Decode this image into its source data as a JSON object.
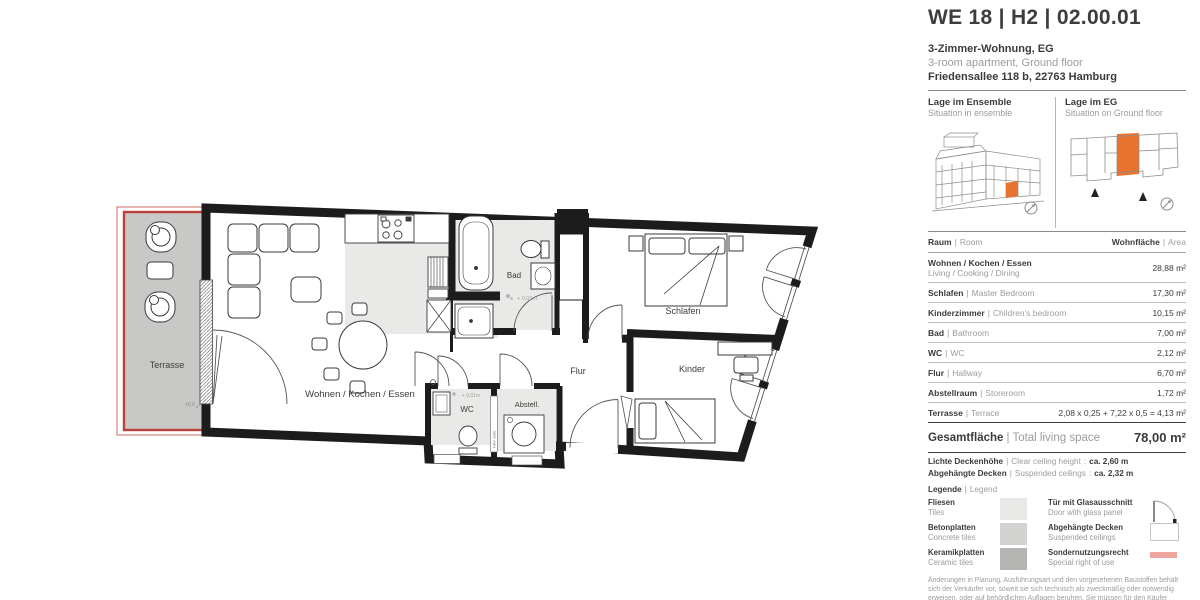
{
  "ui": {
    "sep": "|",
    "colon": ":"
  },
  "header": {
    "title": "WE 18 | H2 | 02.00.01",
    "subtitle_de": "3-Zimmer-Wohnung, EG",
    "subtitle_en": "3-room apartment, Ground floor",
    "address": "Friedensallee 118 b, 22763 Hamburg"
  },
  "location": {
    "ensemble_title": "Lage im Ensemble",
    "ensemble_sub": "Situation in ensemble",
    "floor_title": "Lage im EG",
    "floor_sub": "Situation on Ground floor"
  },
  "table": {
    "header_room_de": "Raum",
    "header_room_en": "Room",
    "header_area_de": "Wohnfläche",
    "header_area_en": "Area",
    "rows": [
      {
        "de": "Wohnen / Kochen / Essen",
        "en": "Living / Cooking / Dining",
        "area": "28,88 m²"
      },
      {
        "de": "Schlafen",
        "en": "Master Bedroom",
        "area": "17,30 m²"
      },
      {
        "de": "Kinderzimmer",
        "en": "Children's bedroom",
        "area": "10,15 m²"
      },
      {
        "de": "Bad",
        "en": "Bathroom",
        "area": "7,00 m²"
      },
      {
        "de": "WC",
        "en": "WC",
        "area": "2,12 m²"
      },
      {
        "de": "Flur",
        "en": "Hallway",
        "area": "6,70 m²"
      },
      {
        "de": "Abstellraum",
        "en": "Storeroom",
        "area": "1,72 m²"
      },
      {
        "de": "Terrasse",
        "en": "Terrace",
        "area": "2,08 x 0,25 + 7,22 x 0,5 = 4,13 m²"
      }
    ],
    "total_de": "Gesamtfläche",
    "total_en": "Total living space",
    "total_area": "78,00 m²"
  },
  "ceiling": {
    "clear_de": "Lichte Deckenhöhe",
    "clear_en": "Clear ceiling height",
    "clear_value": "ca. 2,60 m",
    "susp_de": "Abgehängte Decken",
    "susp_en": "Suspended ceilings",
    "susp_value": "ca. 2,32 m"
  },
  "legend": {
    "title_de": "Legende",
    "title_en": "Legend",
    "items": [
      {
        "de": "Fliesen",
        "en": "Tiles"
      },
      {
        "de": "Betonplatten",
        "en": "Concrete tiles"
      },
      {
        "de": "Keramikplatten",
        "en": "Ceramic tiles"
      },
      {
        "de": "Tür mit Glasausschnitt",
        "en": "Door with glass panel"
      },
      {
        "de": "Abgehängte Decken",
        "en": "Suspended ceilings"
      },
      {
        "de": "Sondernutzungsrecht",
        "en": "Special right of use"
      }
    ]
  },
  "disclaimer": "Änderungen in Planung, Ausführungsart und den vorgesehenen Baustoffen behält sich der Verkäufer vor, soweit sie sich technisch als zweckmäßig oder notwendig erweisen, oder auf behördlichen Auflagen beruhen. Sie müssen für den Käufer zumutbar sein. Die Darstellung der",
  "plan": {
    "labels": {
      "terrasse": "Terrasse",
      "wohnen": "Wohnen / Kochen / Essen",
      "bad": "Bad",
      "schlafen": "Schlafen",
      "kinder": "Kinder",
      "flur": "Flur",
      "wc": "WC",
      "abstell": "Abstell.",
      "level_bad": "+ 0,01m",
      "level_wc": "+ 0,01m",
      "level_terrasse": "±0,0",
      "duct": "HKV verkl."
    }
  },
  "colors": {
    "accent_orange": "#e8732e",
    "terrace_red": "#b9423a",
    "special_use_red": "#eda49c",
    "tile_gray": "#e9e9e7",
    "terrace_gray": "#c8c8c6"
  }
}
